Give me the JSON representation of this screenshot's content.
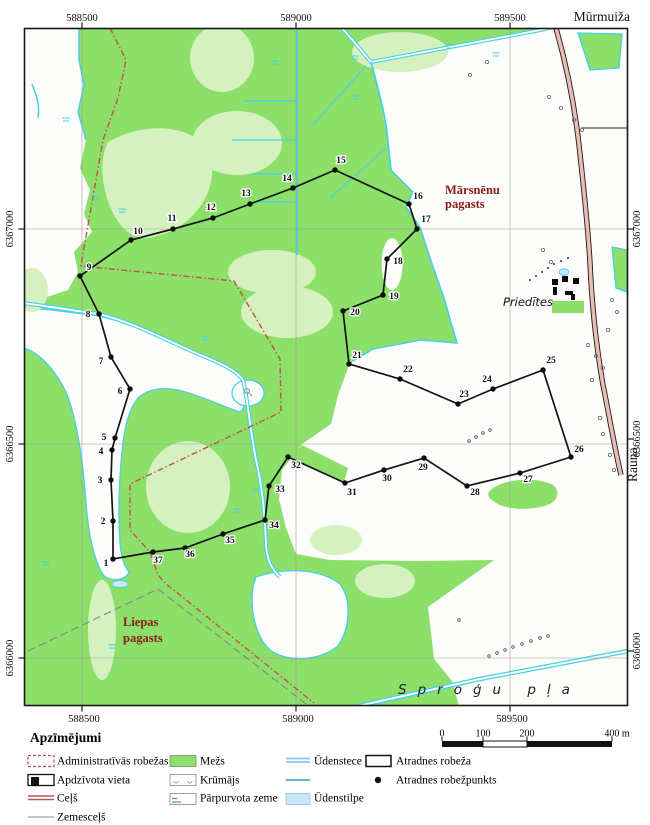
{
  "colors": {
    "forest": "#8CDF69",
    "forest_light": "#D4F1BF",
    "water": "#46D1E8",
    "waterbody": "#C9E7F6",
    "admin": "#C05050",
    "road_fill": "#E9BDB3",
    "district_text": "#8B1A1A"
  },
  "map": {
    "frame": {
      "x": 24.5,
      "y": 28.5,
      "w": 603,
      "h": 677
    },
    "grid": {
      "x": [
        {
          "px": 82,
          "label": "588500"
        },
        {
          "px": 296,
          "label": "589000"
        },
        {
          "px": 510,
          "label": "589500"
        }
      ],
      "y_left": [
        {
          "px": 229,
          "label": "6367000"
        },
        {
          "px": 444,
          "label": "6366500"
        },
        {
          "px": 658,
          "label": "6366000"
        }
      ],
      "y_right": [
        {
          "px": 229,
          "label": "6367000"
        },
        {
          "px": 439,
          "label": "6366500"
        },
        {
          "px": 651,
          "label": "6366000"
        }
      ]
    },
    "places": [
      {
        "id": "murmuiza",
        "text": "Mūrmuiža",
        "x": 630,
        "y": 21,
        "anchor": "end",
        "cls": "pl-big"
      },
      {
        "id": "marsnenu-pagasts",
        "lines": [
          "Mārsnēnu",
          "pagasts"
        ],
        "x": 445,
        "y": 194,
        "lh": 14,
        "cls": "pl-district"
      },
      {
        "id": "liepas-pagasts",
        "lines": [
          "Liepas",
          "pagasts"
        ],
        "x": 123,
        "y": 626,
        "lh": 16,
        "cls": "pl-district"
      },
      {
        "id": "priedites",
        "text": "Priedītes",
        "x": 503,
        "y": 306,
        "cls": "pl-farm"
      },
      {
        "id": "sprogu-plava",
        "text": "Sproģu  pļa",
        "x": 398,
        "y": 694,
        "cls": "pl-meadow",
        "clip": true
      },
      {
        "id": "rauna",
        "text": "Rauna",
        "x": 637,
        "y": 482,
        "cls": "pl-big",
        "rotate": -90
      }
    ],
    "boundary_points": [
      {
        "n": "1",
        "x": 113,
        "y": 559,
        "lx": 106,
        "ly": 566
      },
      {
        "n": "2",
        "x": 113,
        "y": 521,
        "lx": 103,
        "ly": 524
      },
      {
        "n": "3",
        "x": 111,
        "y": 480,
        "lx": 100,
        "ly": 483
      },
      {
        "n": "4",
        "x": 112,
        "y": 450,
        "lx": 101,
        "ly": 454
      },
      {
        "n": "5",
        "x": 115,
        "y": 438,
        "lx": 104,
        "ly": 440
      },
      {
        "n": "6",
        "x": 130,
        "y": 389,
        "lx": 120,
        "ly": 394
      },
      {
        "n": "7",
        "x": 111,
        "y": 357,
        "lx": 101,
        "ly": 364
      },
      {
        "n": "8",
        "x": 99,
        "y": 314,
        "lx": 88,
        "ly": 317
      },
      {
        "n": "9",
        "x": 80,
        "y": 276,
        "lx": 89,
        "ly": 270
      },
      {
        "n": "10",
        "x": 131,
        "y": 240,
        "lx": 138,
        "ly": 234
      },
      {
        "n": "11",
        "x": 173,
        "y": 229,
        "lx": 172,
        "ly": 221
      },
      {
        "n": "12",
        "x": 213,
        "y": 218,
        "lx": 211,
        "ly": 210
      },
      {
        "n": "13",
        "x": 250,
        "y": 204,
        "lx": 246,
        "ly": 196
      },
      {
        "n": "14",
        "x": 293,
        "y": 188,
        "lx": 287,
        "ly": 181
      },
      {
        "n": "15",
        "x": 335,
        "y": 170,
        "lx": 341,
        "ly": 163
      },
      {
        "n": "16",
        "x": 409,
        "y": 204,
        "lx": 418,
        "ly": 199
      },
      {
        "n": "17",
        "x": 417,
        "y": 229,
        "lx": 426,
        "ly": 222
      },
      {
        "n": "18",
        "x": 387,
        "y": 259,
        "lx": 398,
        "ly": 264
      },
      {
        "n": "19",
        "x": 383,
        "y": 295,
        "lx": 394,
        "ly": 299
      },
      {
        "n": "20",
        "x": 343,
        "y": 311,
        "lx": 355,
        "ly": 315
      },
      {
        "n": "21",
        "x": 349,
        "y": 364,
        "lx": 357,
        "ly": 358
      },
      {
        "n": "22",
        "x": 400,
        "y": 379,
        "lx": 408,
        "ly": 372
      },
      {
        "n": "23",
        "x": 458,
        "y": 404,
        "lx": 464,
        "ly": 397
      },
      {
        "n": "24",
        "x": 493,
        "y": 389,
        "lx": 487,
        "ly": 382
      },
      {
        "n": "25",
        "x": 543,
        "y": 370,
        "lx": 551,
        "ly": 363
      },
      {
        "n": "26",
        "x": 571,
        "y": 457,
        "lx": 579,
        "ly": 452
      },
      {
        "n": "27",
        "x": 520,
        "y": 473,
        "lx": 528,
        "ly": 482
      },
      {
        "n": "28",
        "x": 467,
        "y": 486,
        "lx": 475,
        "ly": 495
      },
      {
        "n": "29",
        "x": 424,
        "y": 458,
        "lx": 423,
        "ly": 470
      },
      {
        "n": "30",
        "x": 384,
        "y": 470,
        "lx": 387,
        "ly": 481
      },
      {
        "n": "31",
        "x": 345,
        "y": 483,
        "lx": 352,
        "ly": 495
      },
      {
        "n": "32",
        "x": 288,
        "y": 457,
        "lx": 296,
        "ly": 468
      },
      {
        "n": "33",
        "x": 269,
        "y": 486,
        "lx": 280,
        "ly": 492
      },
      {
        "n": "34",
        "x": 265,
        "y": 520,
        "lx": 274,
        "ly": 528
      },
      {
        "n": "35",
        "x": 223,
        "y": 534,
        "lx": 230,
        "ly": 543
      },
      {
        "n": "36",
        "x": 185,
        "y": 548,
        "lx": 190,
        "ly": 557
      },
      {
        "n": "37",
        "x": 153,
        "y": 552,
        "lx": 158,
        "ly": 563
      }
    ]
  },
  "legend": {
    "title": "Apzīmējumi",
    "col1": [
      "Administratīvās robežas",
      "Apdzīvota vieta",
      "Ceļš",
      "Zemesceļš"
    ],
    "col2": [
      "Mežs",
      "Krūmājs",
      "Pārpurvota zeme"
    ],
    "col3": [
      "Ūdenstece",
      "Ūdenstilpe"
    ],
    "col4": [
      "Atradnes robeža",
      "Atradnes robežpunkts"
    ]
  },
  "scalebar": {
    "labels": [
      "0",
      "100",
      "200"
    ],
    "end_label": "400 m"
  }
}
